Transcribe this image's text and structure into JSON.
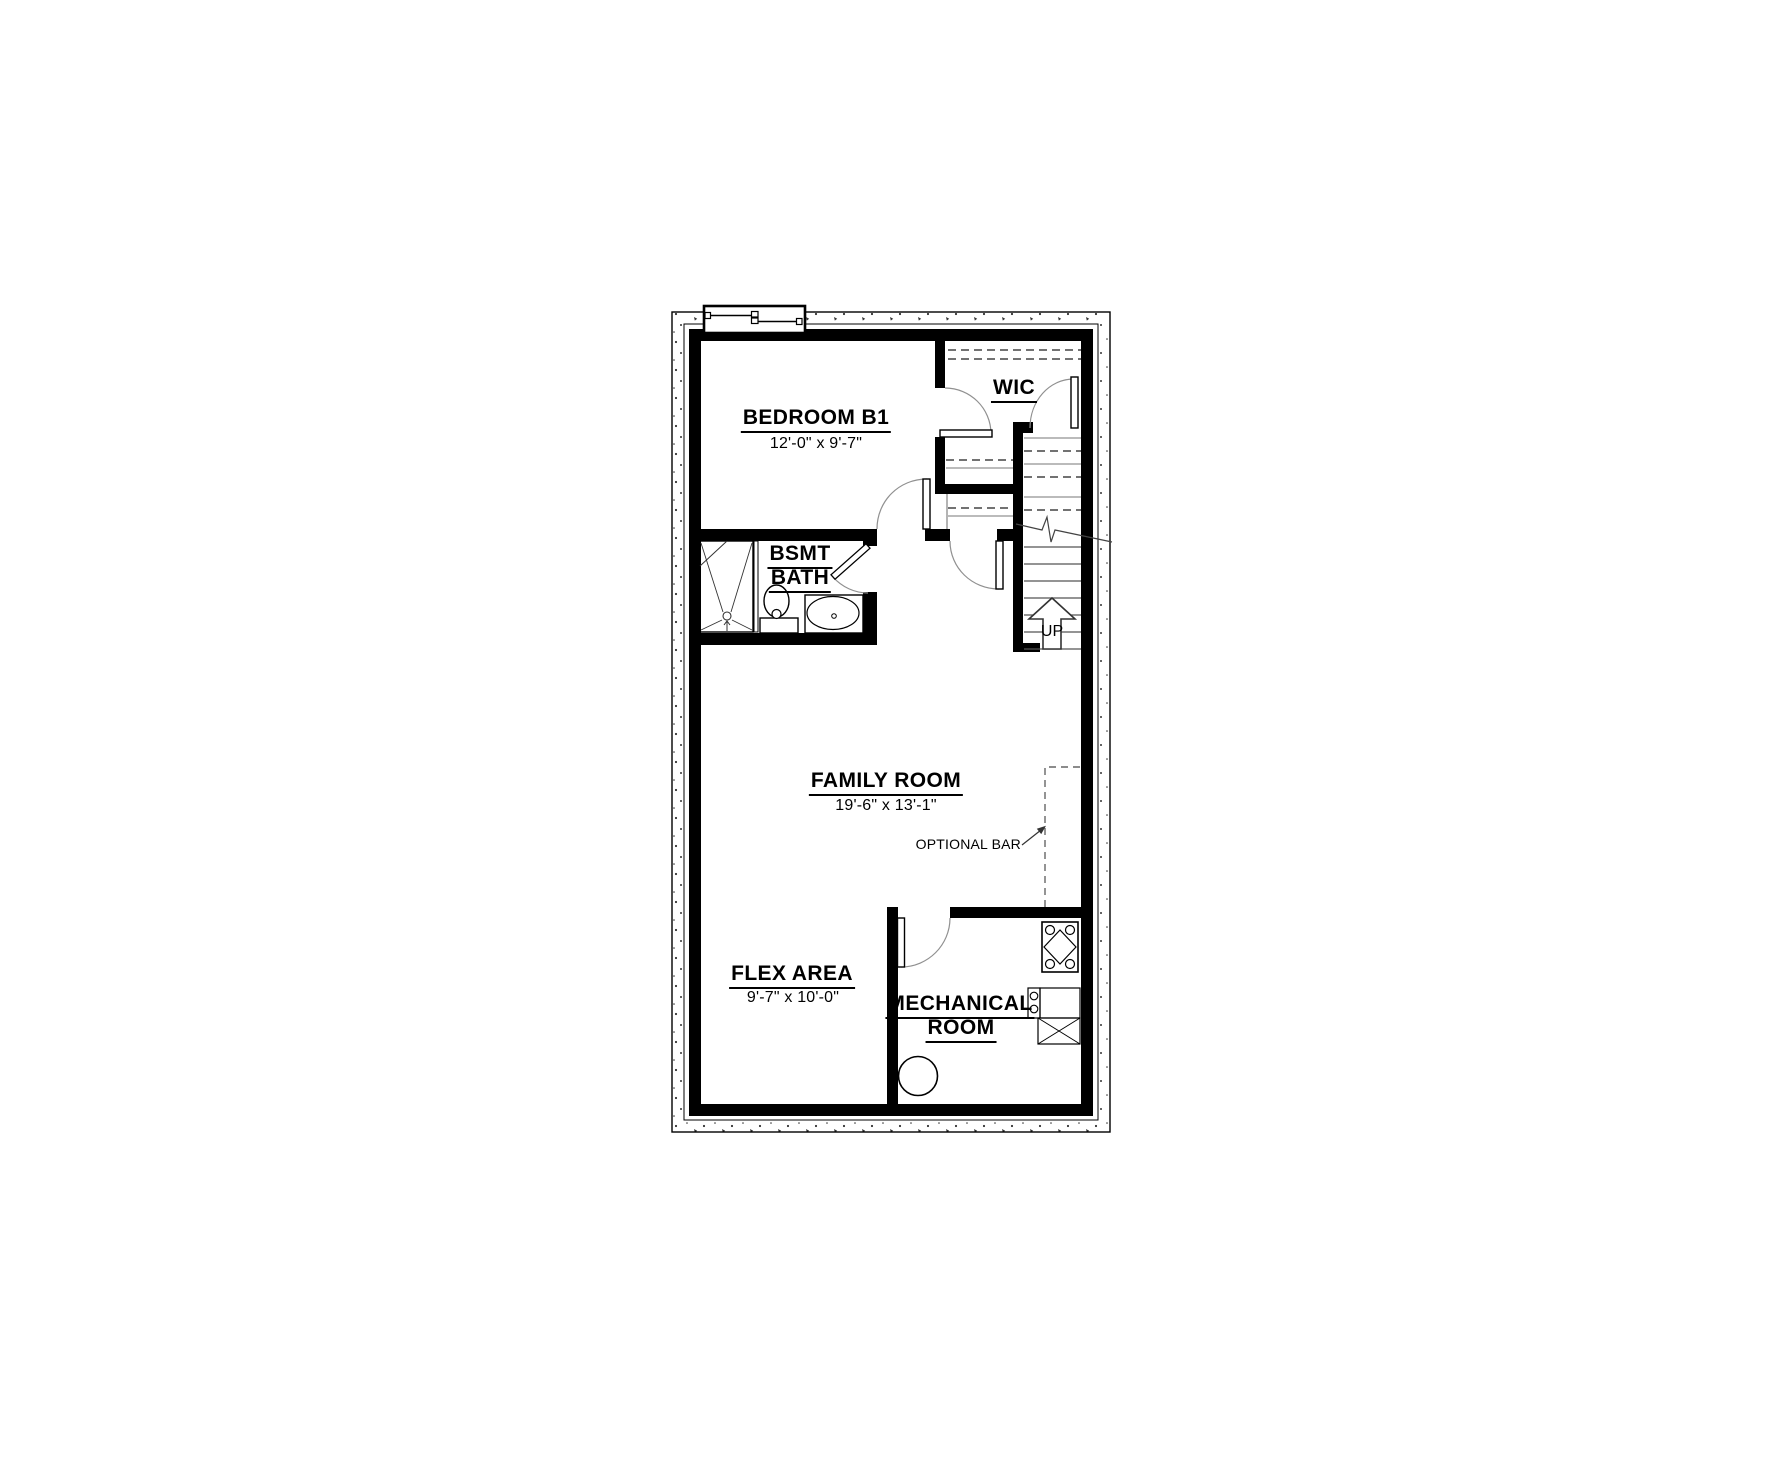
{
  "rooms": {
    "bedroom_b1": {
      "label": "BEDROOM B1",
      "dims": "12'-0\" x 9'-7\""
    },
    "wic": {
      "label": "WIC"
    },
    "bsmt_bath": {
      "line1": "BSMT",
      "line2": "BATH"
    },
    "family_room": {
      "label": "FAMILY ROOM",
      "dims": "19'-6\" x 13'-1\""
    },
    "flex_area": {
      "label": "FLEX AREA",
      "dims": "9'-7\" x 10'-0\""
    },
    "mechanical_room": {
      "line1": "MECHANICAL",
      "line2": "ROOM"
    }
  },
  "annotations": {
    "optional_bar": "OPTIONAL BAR",
    "stairs_up": "UP"
  },
  "colors": {
    "walls": "#000000",
    "tread_lines": "#555555",
    "hidden_dashed": "#444444",
    "door_arcs": "#909090",
    "background": "#ffffff"
  }
}
